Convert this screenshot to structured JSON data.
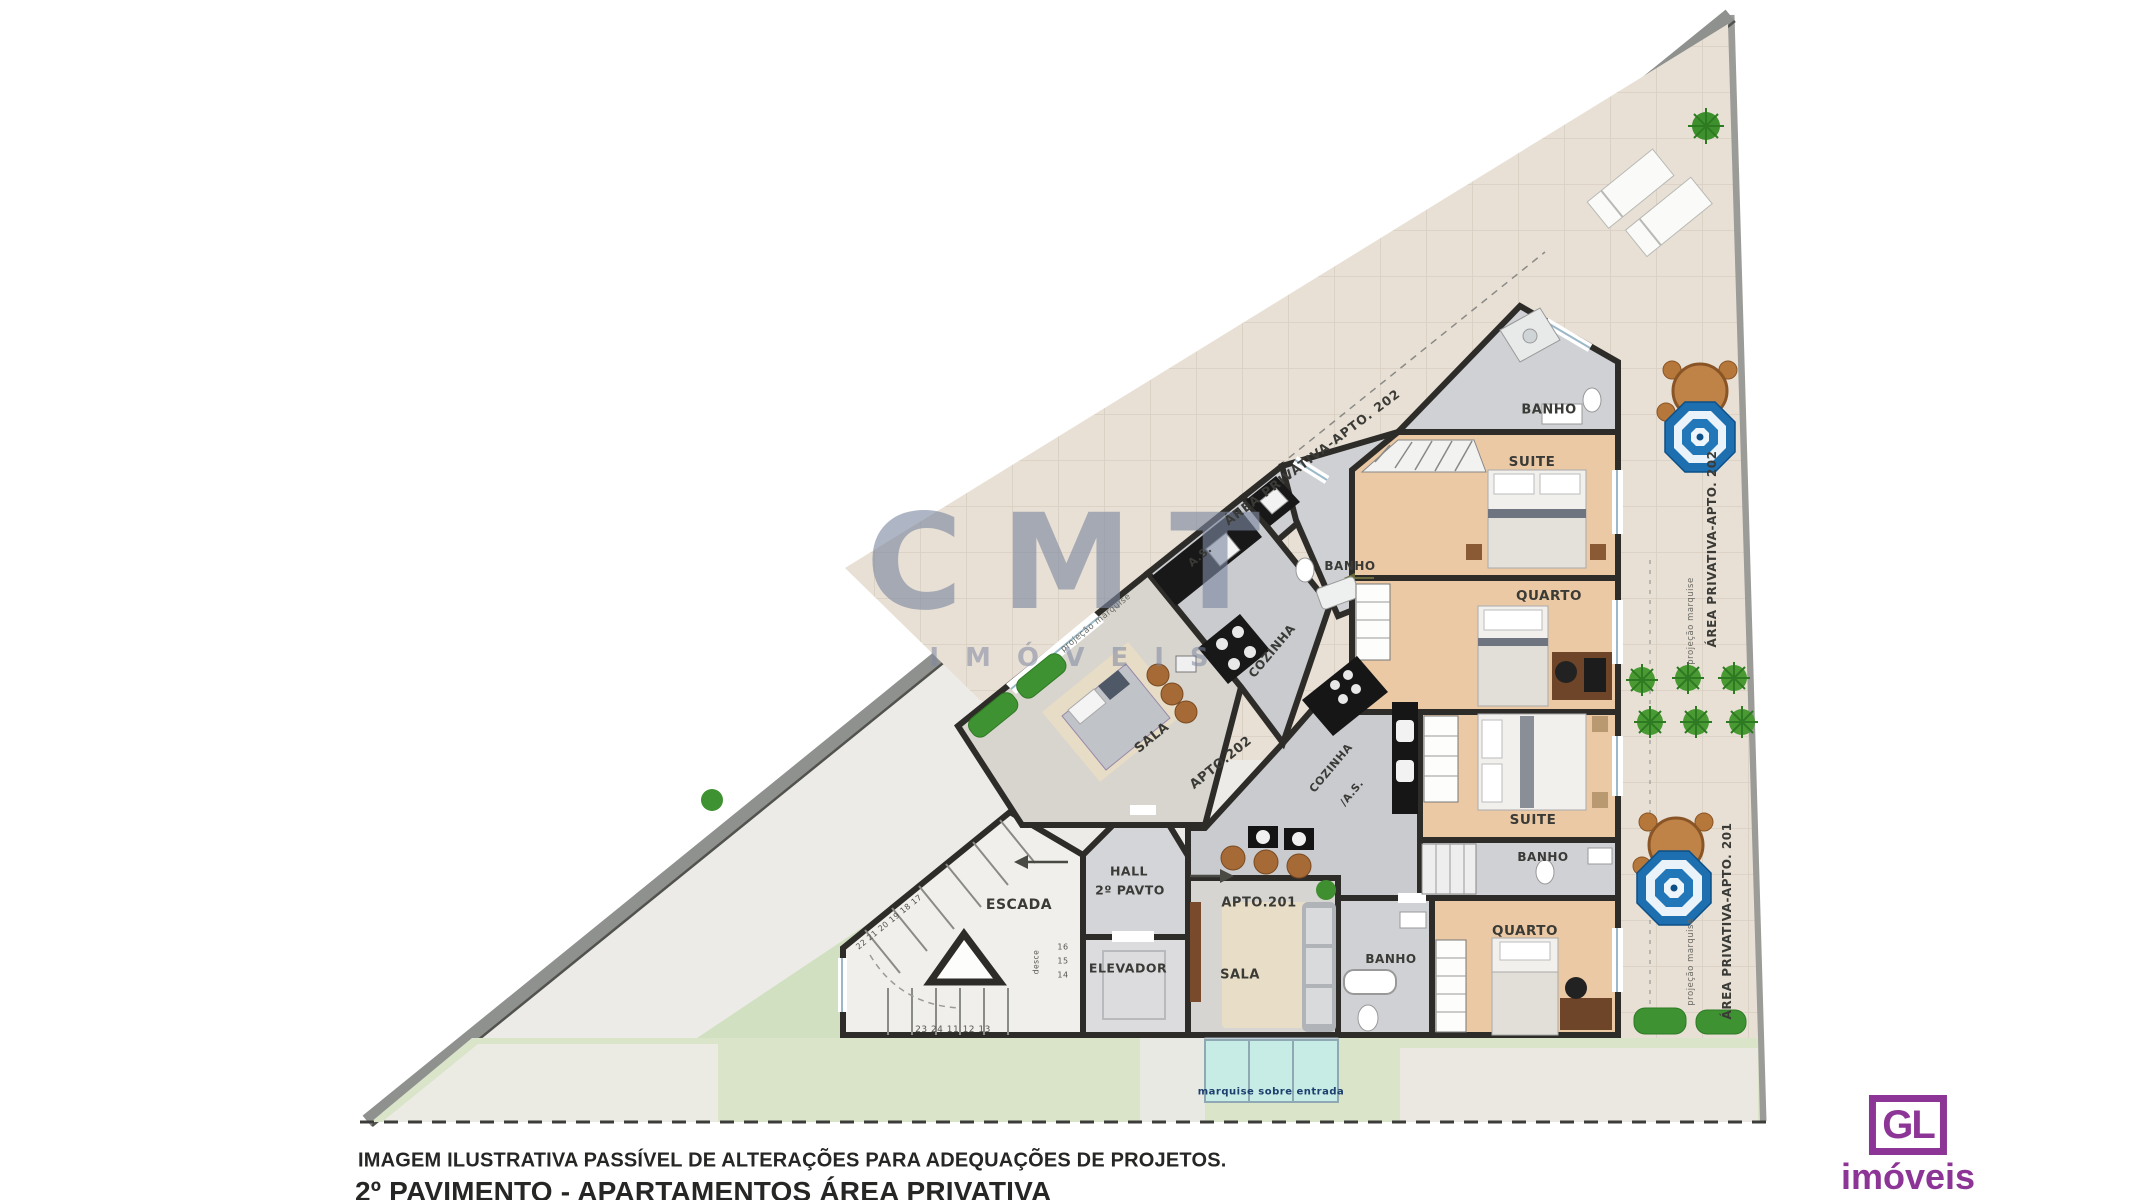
{
  "plan": {
    "rooms": {
      "banho": "BANHO",
      "suite": "SUITE",
      "quarto": "QUARTO",
      "sala": "SALA",
      "cozinha": "COZINHA",
      "as": "A.S.",
      "cozinha_as": "/A.S.",
      "escada": "ESCADA",
      "elevador": "ELEVADOR",
      "hall_line1": "HALL",
      "hall_line2": "2º PAVTO",
      "apto201": "APTO.201",
      "apto202": "APTO.202"
    },
    "areas": {
      "privativa202": "ÁREA PRIVATIVA-APTO. 202",
      "privativa201": "ÁREA PRIVATIVA-APTO. 201",
      "projecao": "projeção marquise",
      "marquise_entrada": "marquise sobre entrada"
    },
    "stairs": {
      "bottom_numbers": "23 24 11 12 13",
      "n14": "14",
      "n15": "15",
      "n16": "16",
      "desce": "desce",
      "diagonal_numbers": "22 21 20 19 18 17"
    }
  },
  "watermark": {
    "name": "CMT",
    "subtitle": "IMÓVEIS"
  },
  "captions": {
    "disclaimer": "IMAGEM ILUSTRATIVA PASSÍVEL DE ALTERAÇÕES PARA ADEQUAÇÕES DE PROJETOS.",
    "title": "2º PAVIMENTO - APARTAMENTOS ÁREA PRIVATIVA"
  },
  "logo": {
    "initials": "GL",
    "name": "imóveis"
  },
  "colors": {
    "brand_purple": "#8c3596",
    "umbrella_blue": "#1d6fb0",
    "wall_black": "#2e2c29",
    "lawn_green": "#d9e4c9",
    "terrace_beige": "#e8e0d5",
    "bedroom_peach": "#ecc9a5",
    "watermark_gray": "#7d87a0"
  }
}
